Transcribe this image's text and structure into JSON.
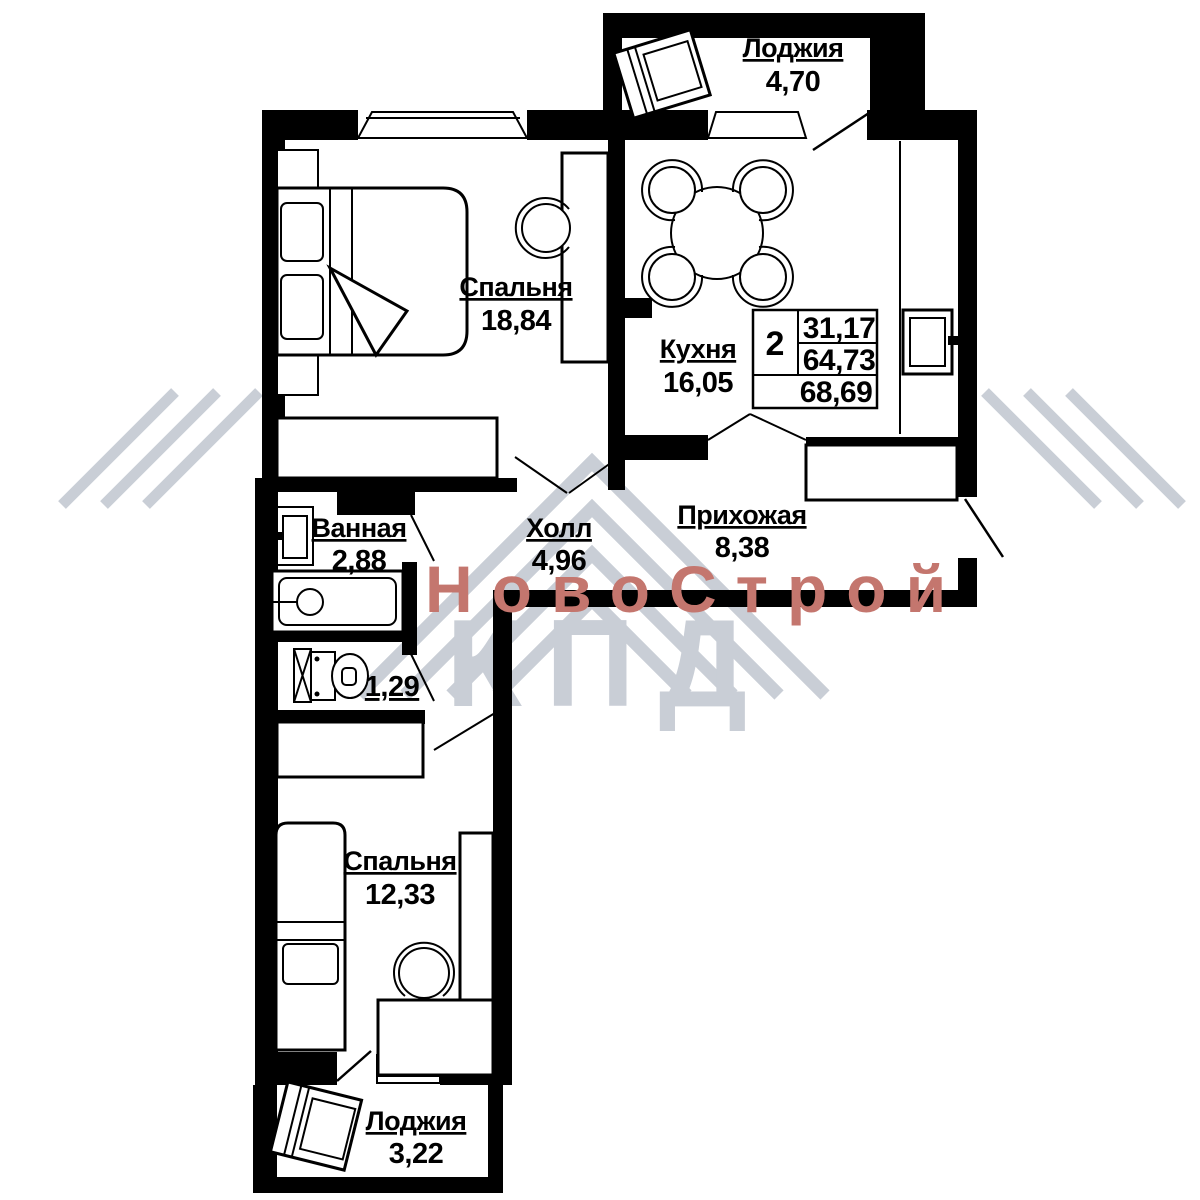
{
  "watermark": {
    "brand_line1": "НовоСтрой",
    "brand_line2": "КПД",
    "accent_color": "#c4766e",
    "gray_color": "#c9ced6"
  },
  "info_table": {
    "rooms_count": "2",
    "living_area": "31,17",
    "apartment_area": "64,73",
    "total_area": "68,69"
  },
  "rooms": [
    {
      "id": "loggia-top",
      "label": "Лоджия",
      "area": "4,70"
    },
    {
      "id": "bedroom-1",
      "label": "Спальня",
      "area": "18,84"
    },
    {
      "id": "kitchen",
      "label": "Кухня",
      "area": "16,05"
    },
    {
      "id": "bathroom",
      "label": "Ванная",
      "area": "2,88"
    },
    {
      "id": "hall",
      "label": "Холл",
      "area": "4,96"
    },
    {
      "id": "entry",
      "label": "Прихожая",
      "area": "8,38"
    },
    {
      "id": "wc",
      "label": "",
      "area": "1,29"
    },
    {
      "id": "bedroom-2",
      "label": "Спальня",
      "area": "12,33"
    },
    {
      "id": "loggia-bottom",
      "label": "Лоджия",
      "area": "3,22"
    }
  ],
  "plan_colors": {
    "walls": "#000000",
    "floor": "#ffffff"
  }
}
